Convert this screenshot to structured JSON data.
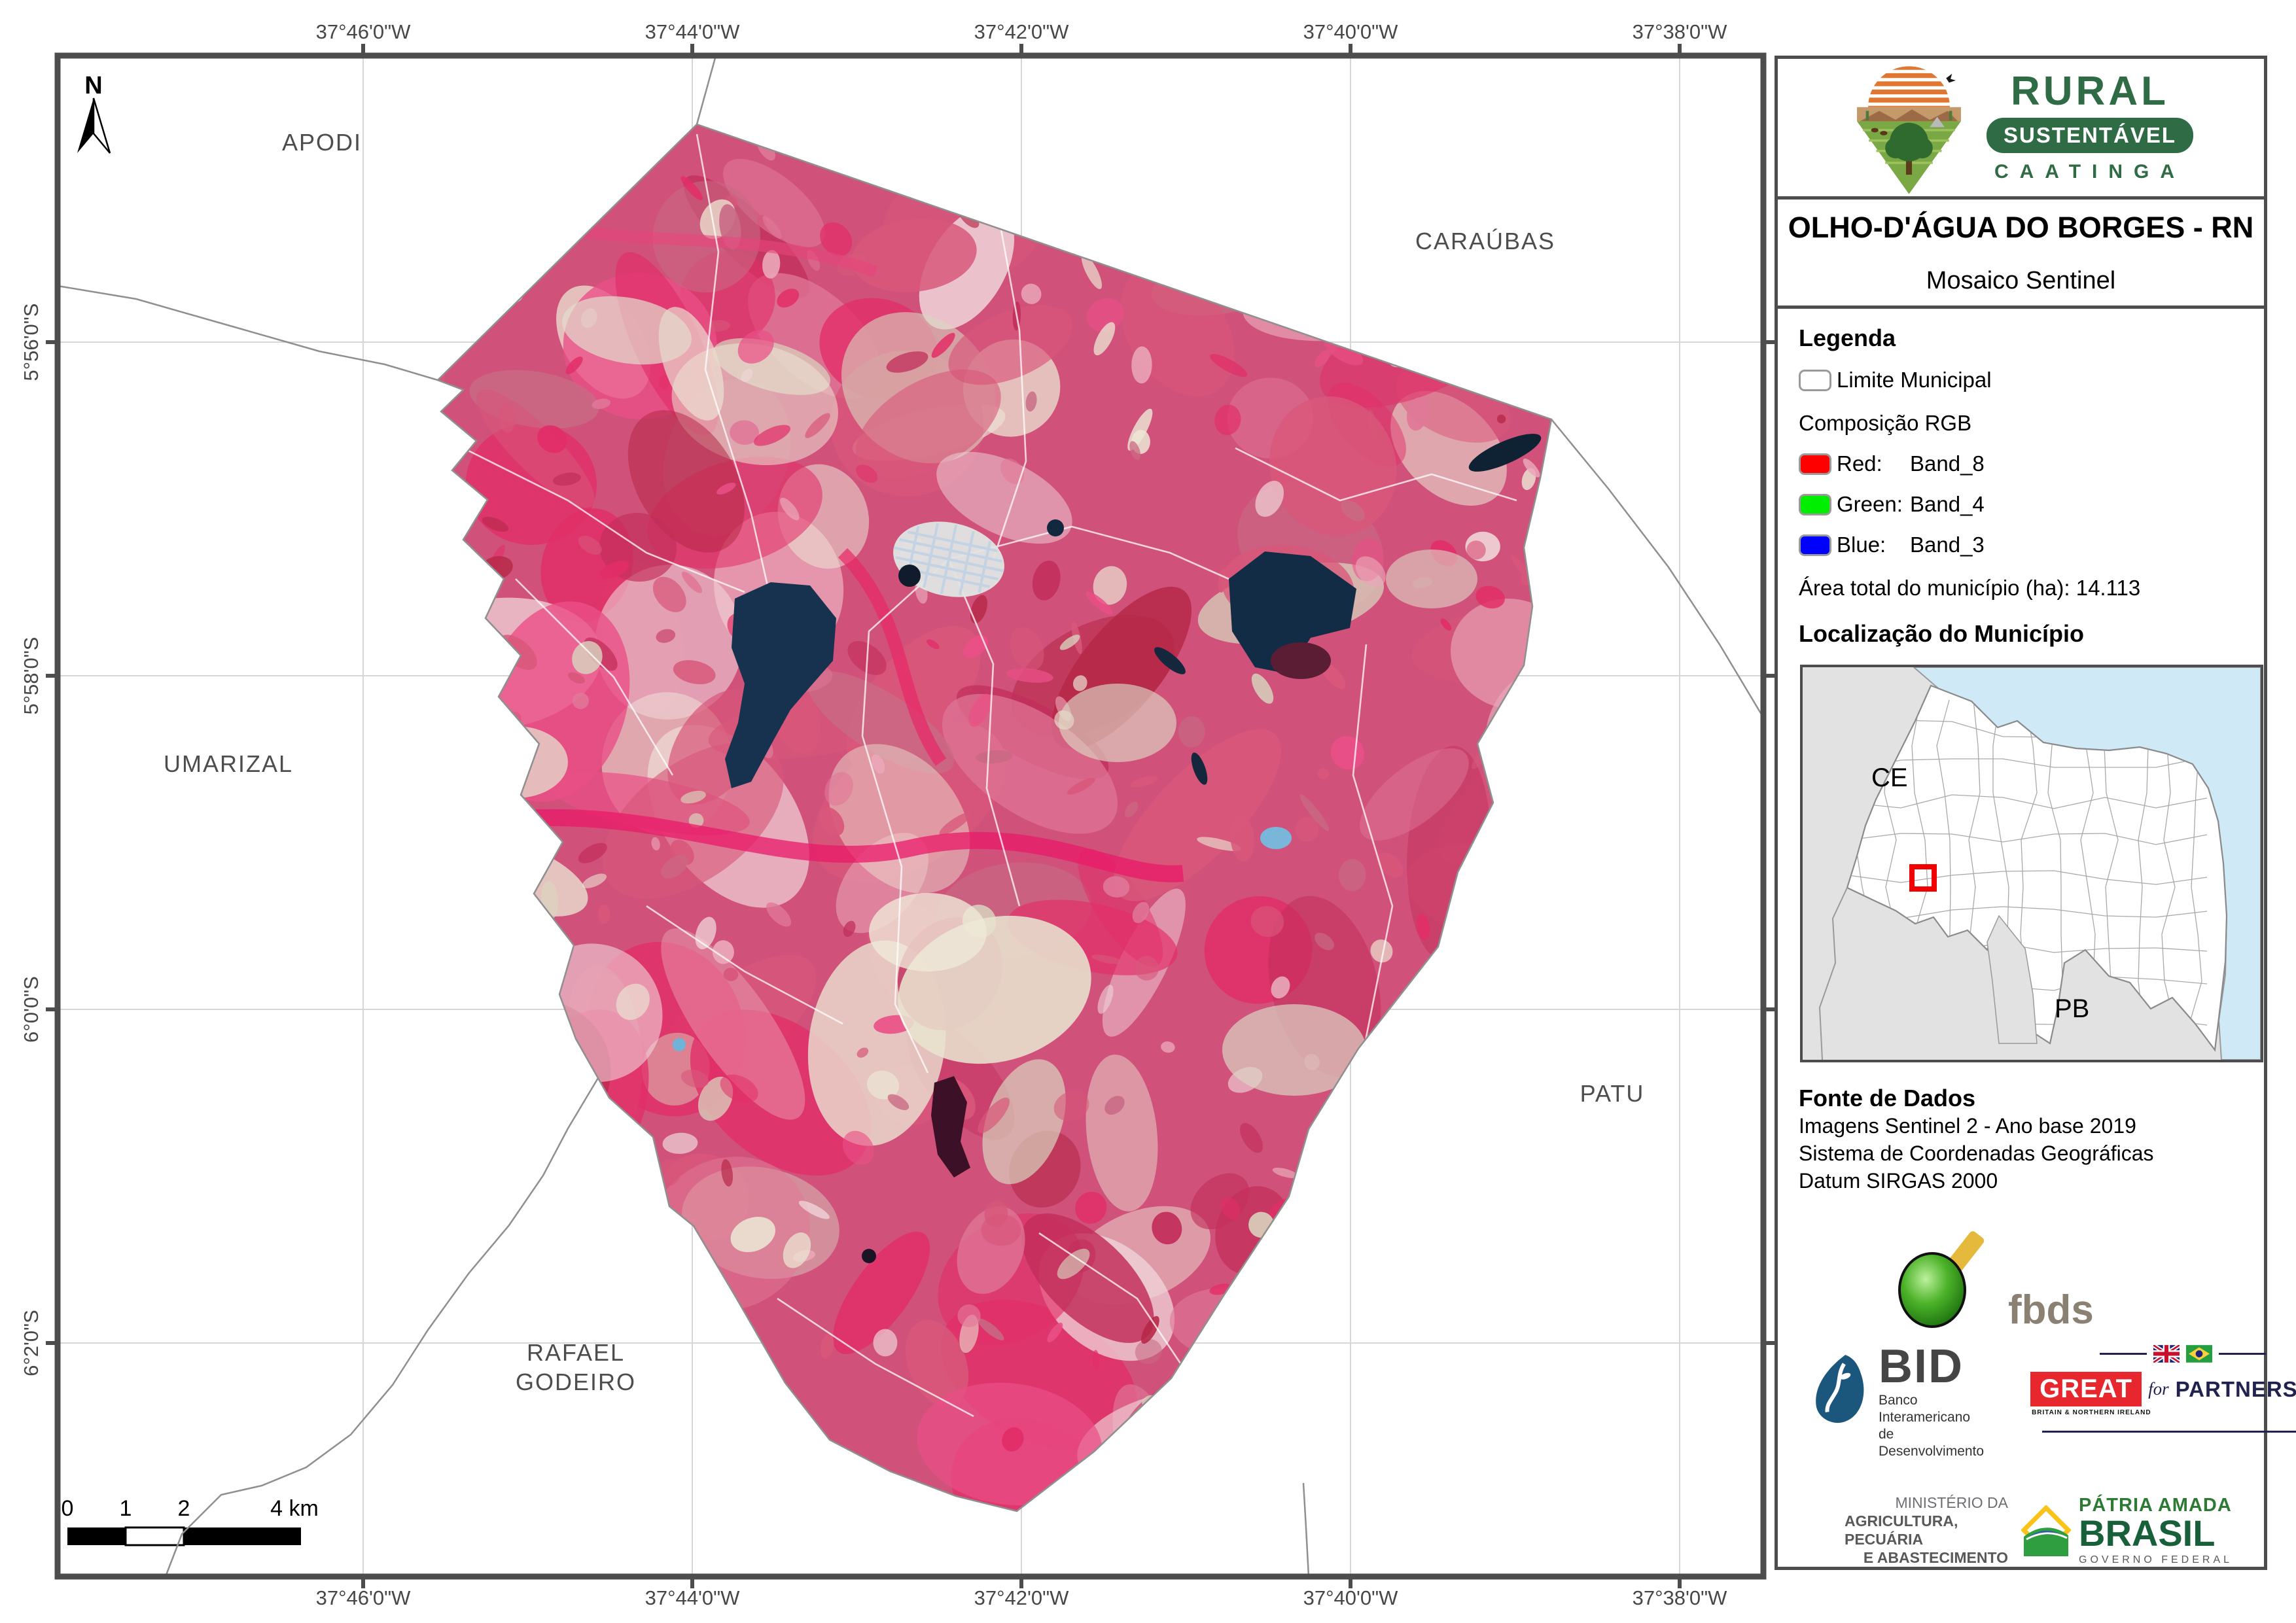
{
  "map": {
    "lon_labels": [
      "37°46'0\"W",
      "37°44'0\"W",
      "37°42'0\"W",
      "37°40'0\"W",
      "37°38'0\"W"
    ],
    "lat_labels": [
      "5°56'0\"S",
      "5°58'0\"S",
      "6°0'0\"S",
      "6°2'0\"S"
    ],
    "north_label": "N",
    "neighbors": {
      "apodi": "APODI",
      "caraubas": "CARAÚBAS",
      "umarizal": "UMARIZAL",
      "patu": "PATU",
      "rafael_line1": "RAFAEL",
      "rafael_line2": "GODEIRO"
    },
    "scalebar": {
      "t0": "0",
      "t1": "1",
      "t2": "2",
      "t4": "4 km"
    }
  },
  "sidebar": {
    "logo": {
      "line1": "RURAL",
      "line2": "SUSTENTÁVEL",
      "line3": "CAATINGA"
    },
    "title": "OLHO-D'ÁGUA DO BORGES - RN",
    "subtitle": "Mosaico Sentinel",
    "legend": {
      "heading": "Legenda",
      "limite": "Limite Municipal",
      "composicao": "Composição RGB",
      "red_label": "Red:",
      "red_value": "Band_8",
      "green_label": "Green:",
      "green_value": "Band_4",
      "blue_label": "Blue:",
      "blue_value": "Band_3",
      "area": "Área total do município (ha): 14.113"
    },
    "localizacao": {
      "heading": "Localização do Município",
      "ce": "CE",
      "pb": "PB"
    },
    "fonte": {
      "heading": "Fonte de Dados",
      "line1": "Imagens Sentinel 2 - Ano base 2019",
      "line2": "Sistema de Coordenadas Geográficas",
      "line3": "Datum SIRGAS 2000"
    },
    "logos": {
      "fbds": "fbds",
      "bid": "BID",
      "bid_sub1": "Banco Interamericano",
      "bid_sub2": "de Desenvolvimento",
      "great": "GREAT",
      "great_for": "for",
      "great_partnership": "PARTNERSHIP",
      "great_sub": "BRITAIN & NORTHERN IRELAND",
      "min1": "MINISTÉRIO DA",
      "min2": "AGRICULTURA, PECUÁRIA",
      "min3": "E ABASTECIMENTO",
      "patria1": "PÁTRIA AMADA",
      "patria2": "BRASIL",
      "patria3": "GOVERNO FEDERAL"
    }
  },
  "colors": {
    "frame": "#4d4d4d",
    "legend_red": "#ff0000",
    "legend_green": "#00ff00",
    "legend_blue": "#0000ff",
    "limite_swatch": "#ffffff",
    "ocean": "#cfe9f7",
    "land_gray": "#e2e2e2",
    "highlight_red": "#f00000",
    "brand_green": "#2f6b45"
  }
}
